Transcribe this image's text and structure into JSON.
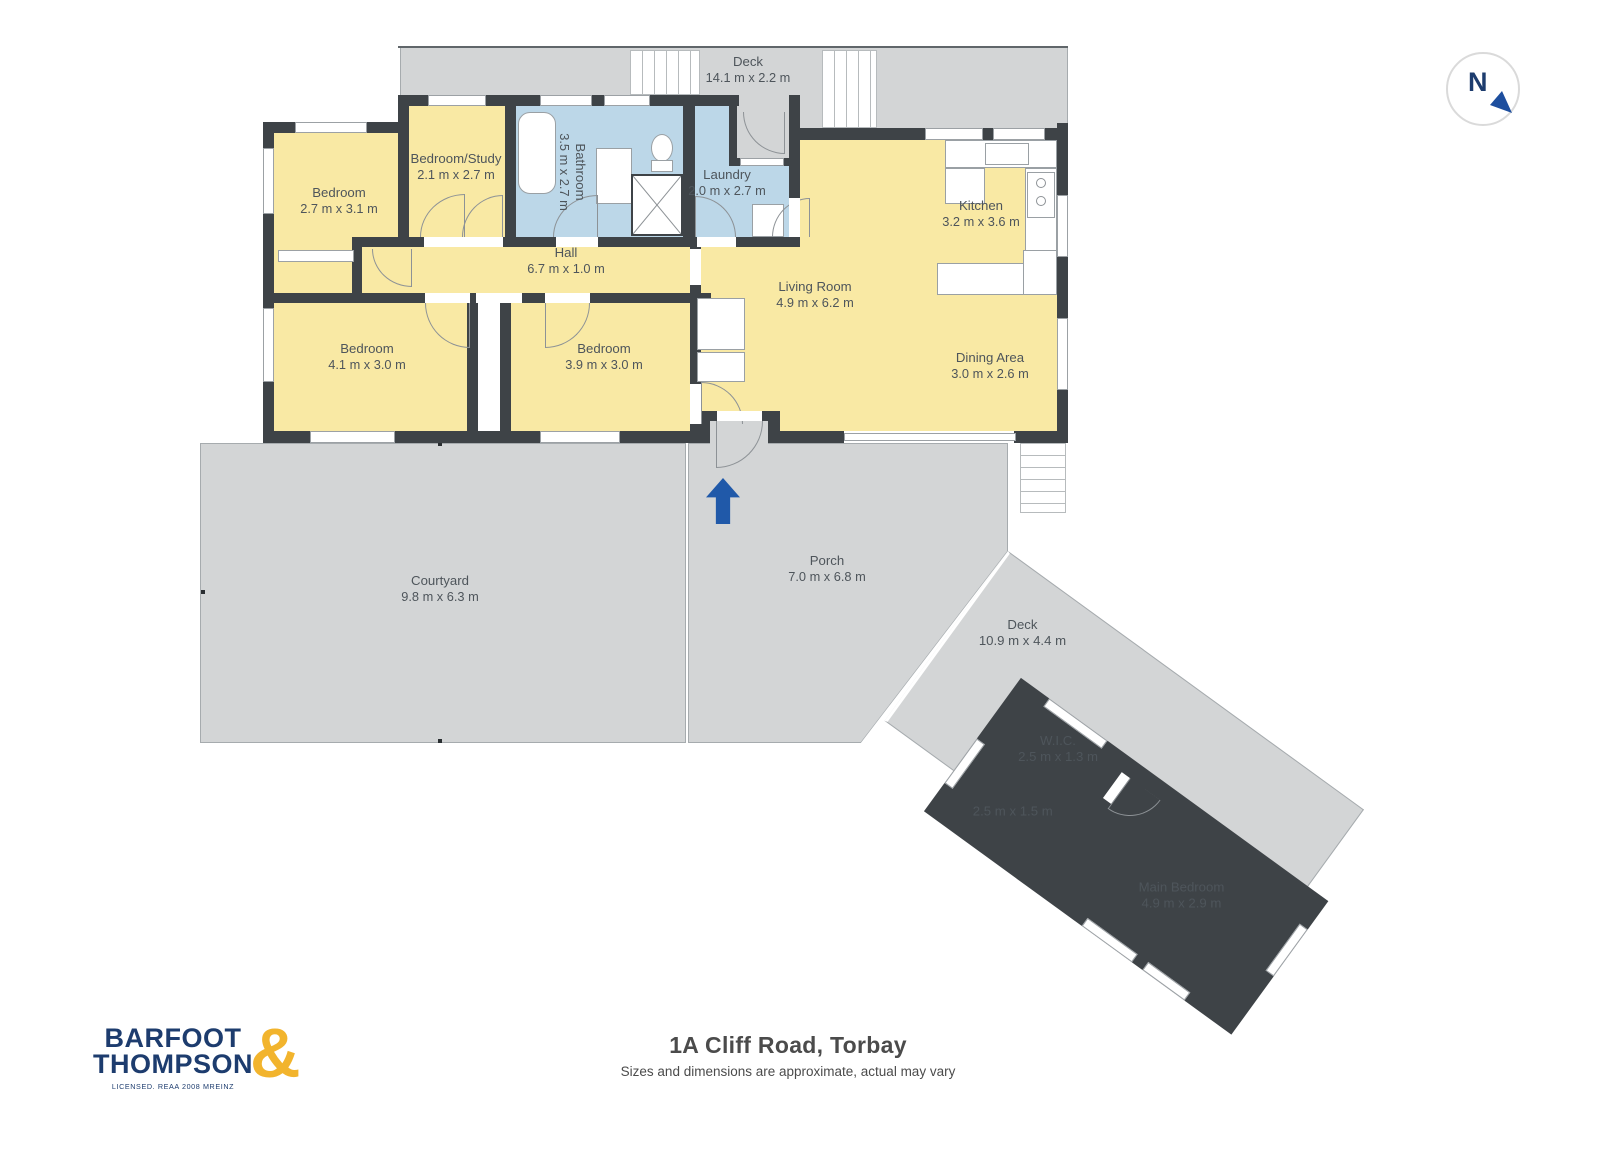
{
  "title": {
    "address": "1A Cliff Road, Torbay",
    "disclaimer": "Sizes and dimensions are approximate, actual may vary"
  },
  "branding": {
    "name_line1": "BARFOOT",
    "name_line2": "THOMPSON",
    "ampersand": "&",
    "license_text": "LICENSED. REAA 2008 MREINZ"
  },
  "compass": {
    "north_label": "N"
  },
  "colors": {
    "wall": "#3E4347",
    "room_fill": "#F9E9A4",
    "wet_fill": "#BCD7E8",
    "outdoor_fill": "#D3D5D6",
    "outline": "#A6ABAE",
    "arrow_blue": "#2059A9",
    "brand_navy": "#1D3C6E",
    "brand_gold": "#F2B42D",
    "label_text": "#4E555B",
    "title_text": "#4B4B4B"
  },
  "rooms": {
    "deck_top": {
      "name": "Deck",
      "dims": "14.1 m x 2.2 m"
    },
    "bedroom_left": {
      "name": "Bedroom",
      "dims": "2.7 m x 3.1 m"
    },
    "bedroom_study": {
      "name": "Bedroom/Study",
      "dims": "2.1 m x 2.7 m"
    },
    "bathroom": {
      "name": "Bathroom",
      "dims": "3.5 m x 2.7 m"
    },
    "laundry": {
      "name": "Laundry",
      "dims": "2.0 m x 2.7 m"
    },
    "kitchen": {
      "name": "Kitchen",
      "dims": "3.2 m x 3.6 m"
    },
    "hall": {
      "name": "Hall",
      "dims": "6.7 m x 1.0 m"
    },
    "living_room": {
      "name": "Living Room",
      "dims": "4.9 m x 6.2 m"
    },
    "bedroom_mid": {
      "name": "Bedroom",
      "dims": "4.1 m x 3.0 m"
    },
    "bedroom_right": {
      "name": "Bedroom",
      "dims": "3.9 m x 3.0 m"
    },
    "dining_area": {
      "name": "Dining Area",
      "dims": "3.0 m x 2.6 m"
    },
    "courtyard": {
      "name": "Courtyard",
      "dims": "9.8 m x 6.3 m"
    },
    "porch": {
      "name": "Porch",
      "dims": "7.0 m x 6.8 m"
    },
    "deck_lower": {
      "name": "Deck",
      "dims": "10.9 m x 4.4 m"
    },
    "wic": {
      "name": "W.I.C.",
      "dims": "2.5 m x 1.3 m"
    },
    "ensuite": {
      "dims": "2.5 m x 1.5 m"
    },
    "main_bedroom": {
      "name": "Main Bedroom",
      "dims": "4.9 m x 2.9 m"
    }
  }
}
